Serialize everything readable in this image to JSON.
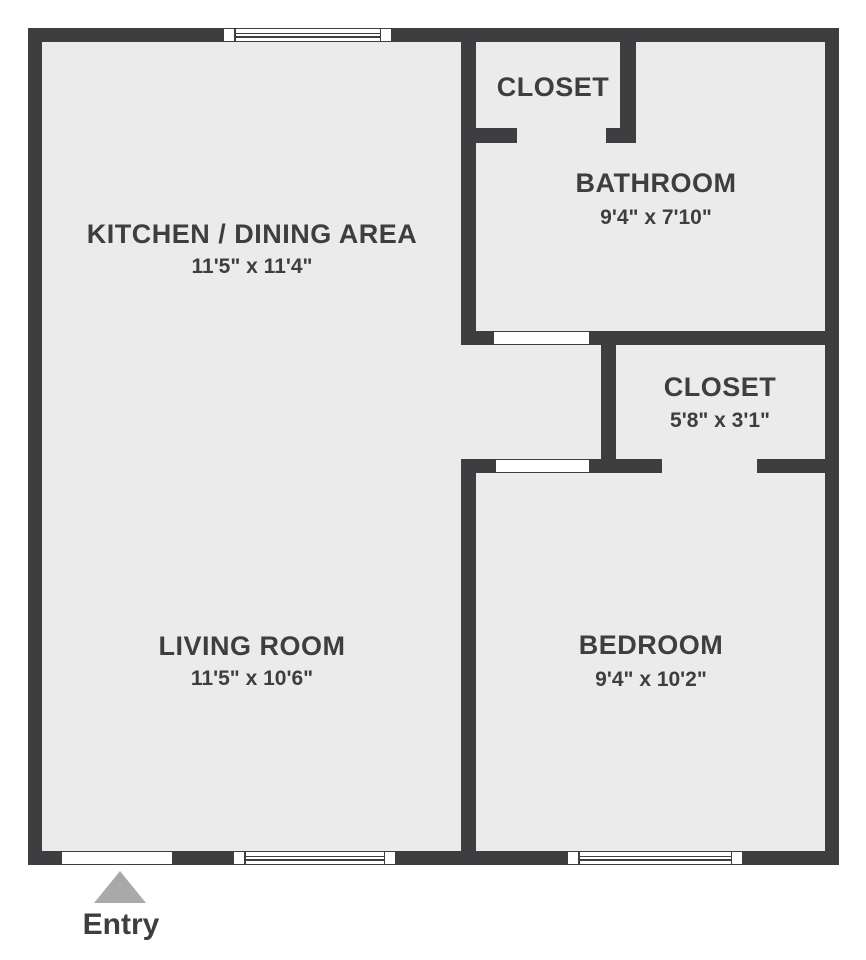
{
  "plan": {
    "rooms": {
      "kitchen": {
        "name": "KITCHEN / DINING AREA",
        "dims": "11'5\" x 11'4\""
      },
      "closet_top": {
        "name": "CLOSET"
      },
      "bathroom": {
        "name": "BATHROOM",
        "dims": "9'4\" x 7'10\""
      },
      "closet_bedroom": {
        "name": "CLOSET",
        "dims": "5'8\" x 3'1\""
      },
      "living": {
        "name": "LIVING ROOM",
        "dims": "11'5\" x 10'6\""
      },
      "bedroom": {
        "name": "BEDROOM",
        "dims": "9'4\" x 10'2\""
      }
    },
    "entry_label": "Entry",
    "colors": {
      "wall": "#3e3e40",
      "floor": "#ebebeb",
      "text": "#3d3e40",
      "opening": "#ffffff",
      "entry_arrow": "#a9a9a9",
      "background": "#ffffff"
    }
  }
}
